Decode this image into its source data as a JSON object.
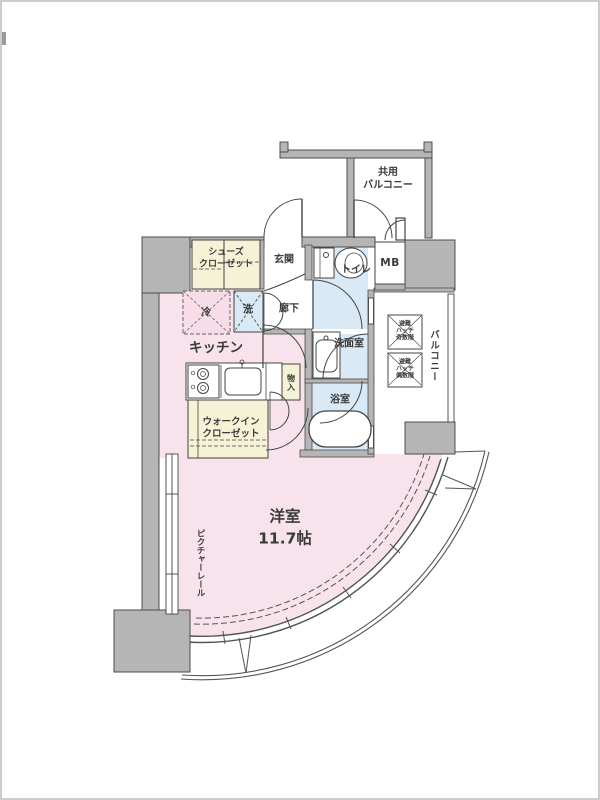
{
  "palette": {
    "wall_fill": "#b5b5b5",
    "wall_outline": "#4d4d4d",
    "line": "#444444",
    "room_pink": "#f8e3ec",
    "room_blue": "#d9e9f5",
    "room_cream": "#f6f2d6",
    "floor_white": "#ffffff"
  },
  "labels": {
    "shared_balcony": {
      "line1": "共用",
      "line2": "バルコニー"
    },
    "shoe_closet": {
      "line1": "シューズ",
      "line2": "クローゼット"
    },
    "entrance": {
      "text": "玄関"
    },
    "toilet": {
      "text": "トイレ"
    },
    "meter_box": {
      "text": "MB"
    },
    "hallway": {
      "text": "廊下"
    },
    "fridge": {
      "text": "冷"
    },
    "washer": {
      "text": "洗"
    },
    "kitchen": {
      "text": "キッチン"
    },
    "washroom": {
      "text": "洗面室"
    },
    "bathroom": {
      "text": "浴室"
    },
    "storage": {
      "text": "物入"
    },
    "walk_in_closet": {
      "line1": "ウォークイン",
      "line2": "クローゼット"
    },
    "main_room": {
      "name": "洋室",
      "size": "11.7帖"
    },
    "picture_rail": {
      "text": "ピクチャーレール"
    },
    "side_balcony": {
      "text": "バルコニー"
    },
    "hatch_odd": {
      "line1": "避難",
      "line2": "ハッチ",
      "line3": "奇数階"
    },
    "hatch_even": {
      "line1": "避難",
      "line2": "ハッチ",
      "line3": "偶数階"
    }
  }
}
